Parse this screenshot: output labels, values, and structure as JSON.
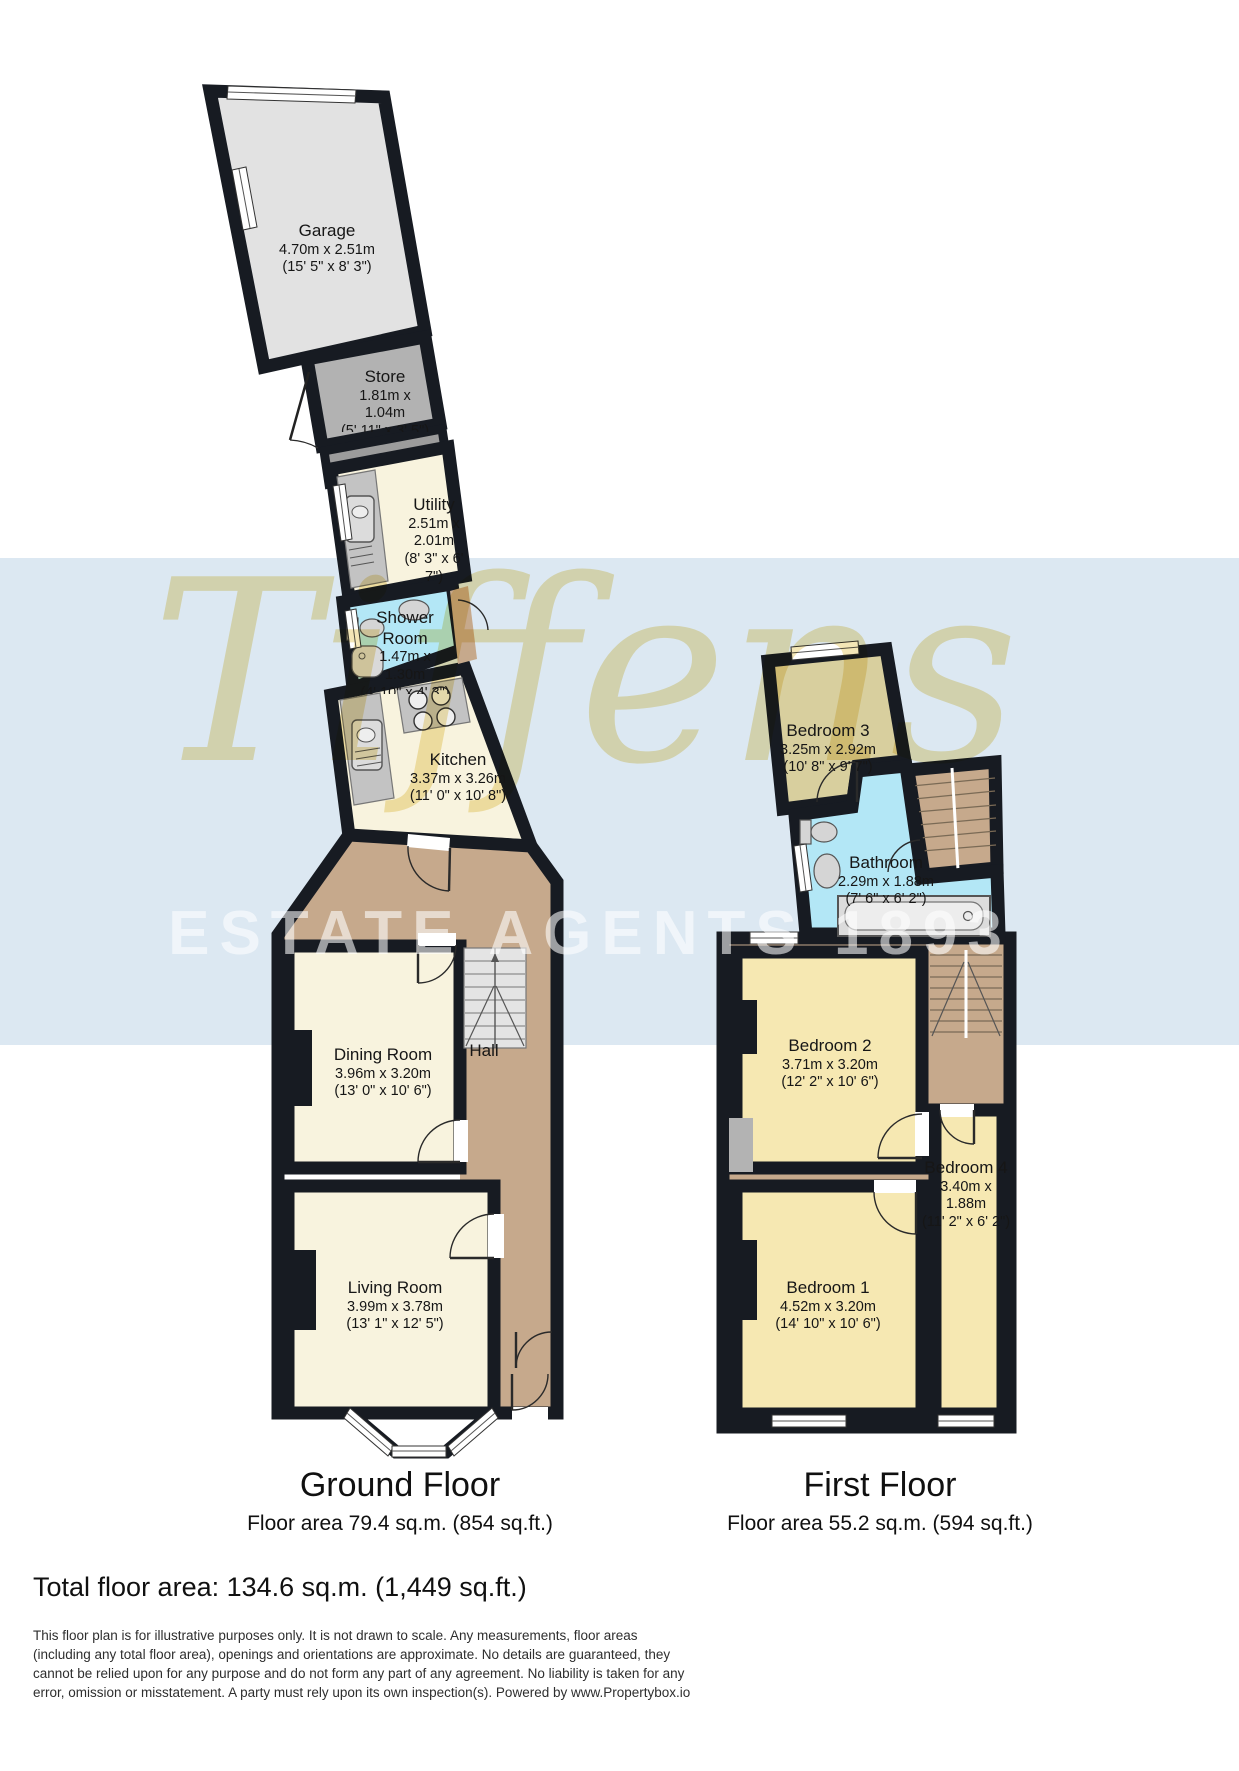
{
  "watermark": {
    "brand": "Tiffens",
    "subtitle": "ESTATE AGENTS 1893"
  },
  "colors": {
    "wall": "#171b22",
    "ground_room": "#f8f3de",
    "bedroom": "#f6e8b2",
    "bedroom3": "#d8cf9e",
    "wet_room": "#b3e7f6",
    "hall": "#c6a98c",
    "garage": "#e2e2e2",
    "store": "#b2b2b2",
    "watermark_band": "#dce8f2",
    "watermark_text": "#f3e5b2"
  },
  "ground_floor": {
    "title": "Ground Floor",
    "area": "Floor area 79.4 sq.m. (854 sq.ft.)",
    "rooms": {
      "garage": {
        "name": "Garage",
        "l1": "4.70m x 2.51m",
        "l2": "(15' 5\" x 8' 3\")"
      },
      "store": {
        "name": "Store",
        "l1": "1.81m x",
        "l2": "1.04m",
        "l3": "(5' 11\" x 3' 5\")"
      },
      "utility": {
        "name": "Utility",
        "l1": "2.51m x",
        "l2": "2.01m",
        "l3": "(8' 3\" x 6'",
        "l4": "7\")"
      },
      "shower": {
        "name": "Shower",
        "name2": "Room",
        "l1": "1.47m x",
        "l2": "1.30m",
        "l3": "(4' 10\" x 4' 3\")"
      },
      "kitchen": {
        "name": "Kitchen",
        "l1": "3.37m x 3.26m",
        "l2": "(11' 0\" x 10' 8\")"
      },
      "dining": {
        "name": "Dining Room",
        "l1": "3.96m x 3.20m",
        "l2": "(13' 0\" x 10' 6\")"
      },
      "living": {
        "name": "Living Room",
        "l1": "3.99m x 3.78m",
        "l2": "(13' 1\" x 12' 5\")"
      },
      "hall": {
        "name": "Hall"
      }
    }
  },
  "first_floor": {
    "title": "First Floor",
    "area": "Floor area 55.2 sq.m. (594 sq.ft.)",
    "rooms": {
      "bedroom3": {
        "name": "Bedroom 3",
        "l1": "3.25m x 2.92m",
        "l2": "(10' 8\" x 9' 7\")"
      },
      "bathroom": {
        "name": "Bathroom",
        "l1": "2.29m x 1.88m",
        "l2": "(7' 6\" x 6' 2\")"
      },
      "bedroom2": {
        "name": "Bedroom 2",
        "l1": "3.71m x 3.20m",
        "l2": "(12' 2\" x 10' 6\")"
      },
      "bedroom1": {
        "name": "Bedroom 1",
        "l1": "4.52m x 3.20m",
        "l2": "(14' 10\" x 10' 6\")"
      },
      "bedroom4": {
        "name": "Bedroom 4",
        "l1": "3.40m x",
        "l2": "1.88m",
        "l3": "(11' 2\" x 6' 2\")"
      }
    }
  },
  "footer": {
    "total": "Total floor area: 134.6 sq.m. (1,449 sq.ft.)",
    "disclaimer": "This floor plan is for illustrative purposes only. It is not drawn to scale. Any measurements, floor areas (including any total floor area), openings and orientations are approximate. No details are guaranteed, they cannot be relied upon for any purpose and do not form any part of any agreement. No liability is taken for any error, omission or misstatement. A party must rely upon its own inspection(s). Powered by www.Propertybox.io"
  }
}
